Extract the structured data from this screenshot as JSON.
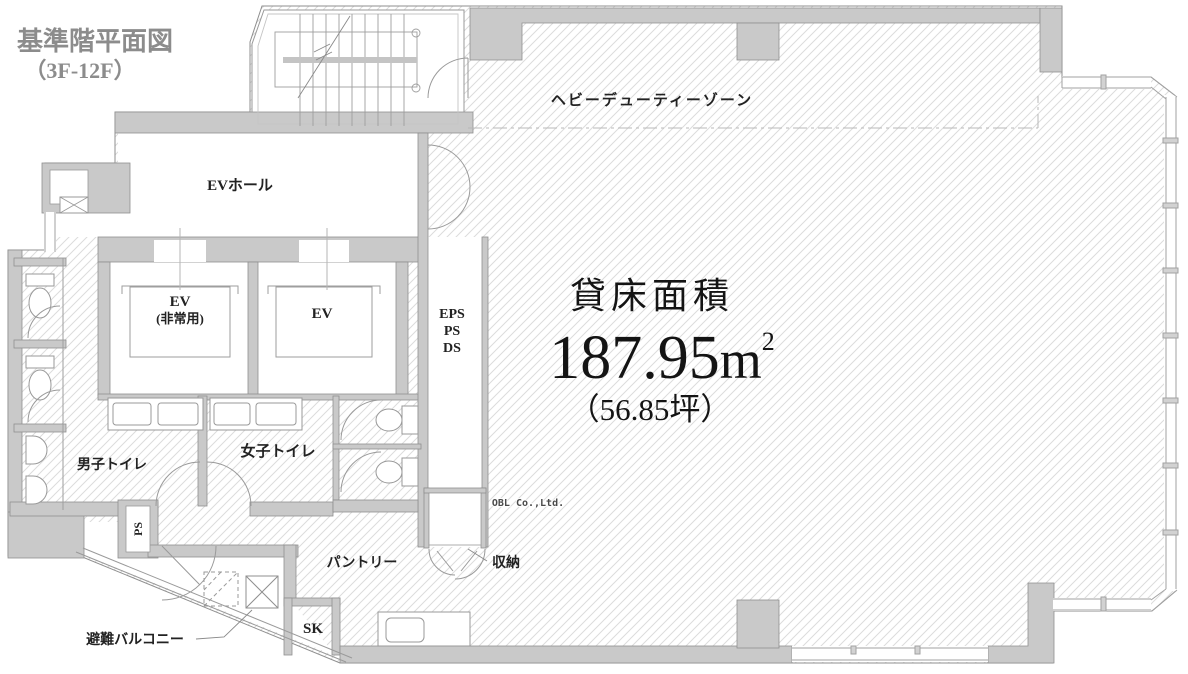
{
  "title": {
    "line1": "基準階平面図",
    "line2": "（3F-12F）"
  },
  "zones": {
    "heavy_duty": "ヘビーデューティーゾーン"
  },
  "rooms": {
    "ev_hall": "EVホール",
    "ev_emergency_line1": "EV",
    "ev_emergency_line2": "(非常用)",
    "ev": "EV",
    "shaft_line1": "EPS",
    "shaft_line2": "PS",
    "shaft_line3": "DS",
    "mens_toilet": "男子トイレ",
    "womens_toilet": "女子トイレ",
    "pantry": "パントリー",
    "storage": "収納",
    "sk": "SK",
    "ps": "PS",
    "balcony": "避難バルコニー"
  },
  "area": {
    "label": "貸床面積",
    "value": "187.95",
    "unit": "m",
    "unit_sup": "2",
    "tsubo": "（56.85坪）"
  },
  "watermark": "OBL Co.,Ltd.",
  "colors": {
    "wall": "#c9c9c9",
    "wall_stroke": "#8f8f8f",
    "hatch": "#dcdcdc",
    "label_text": "#222222",
    "title_gray": "#8c8c8c"
  }
}
